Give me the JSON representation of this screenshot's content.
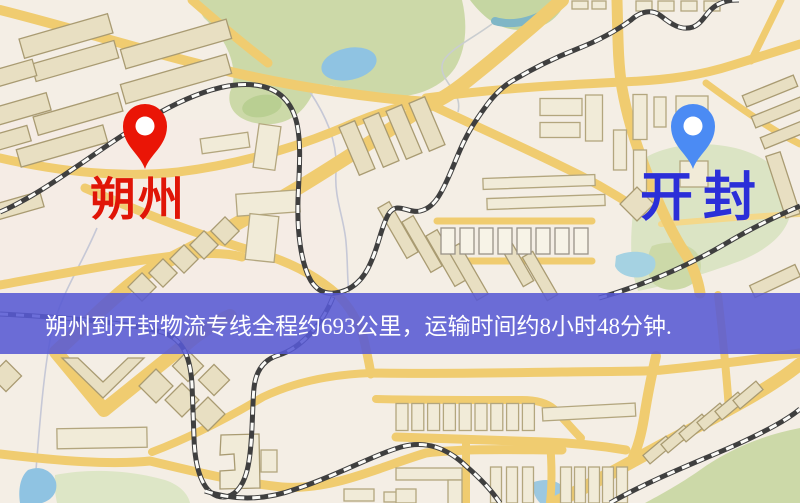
{
  "banner": {
    "text": "朔州到开封物流专线全程约693公里，运输时间约8小时48分钟.",
    "background_color": "rgba(88,90,212,0.88)",
    "text_color": "#ffffff"
  },
  "markers": {
    "origin": {
      "label": "朔州",
      "pin_color": "#ea1506",
      "pin_hole_color": "#ffffff",
      "label_color": "#e01507"
    },
    "destination": {
      "label": "开封",
      "pin_color": "#4b8bf4",
      "pin_hole_color": "#ffffff",
      "label_color": "#2b2fd8"
    }
  },
  "map_colors": {
    "background": "#f4eee5",
    "road_yellow": "#f0cc70",
    "road_minor": "#f4d88a",
    "park_green": "#ccd9a8",
    "park_green_pale": "#dde6c6",
    "water_blue": "#8fc3e2",
    "stream_teal": "#7fb6c6",
    "railway_dark": "#3f3f3f",
    "building_tan": "#e8dfc2",
    "building_cream": "#f1ebd8"
  }
}
